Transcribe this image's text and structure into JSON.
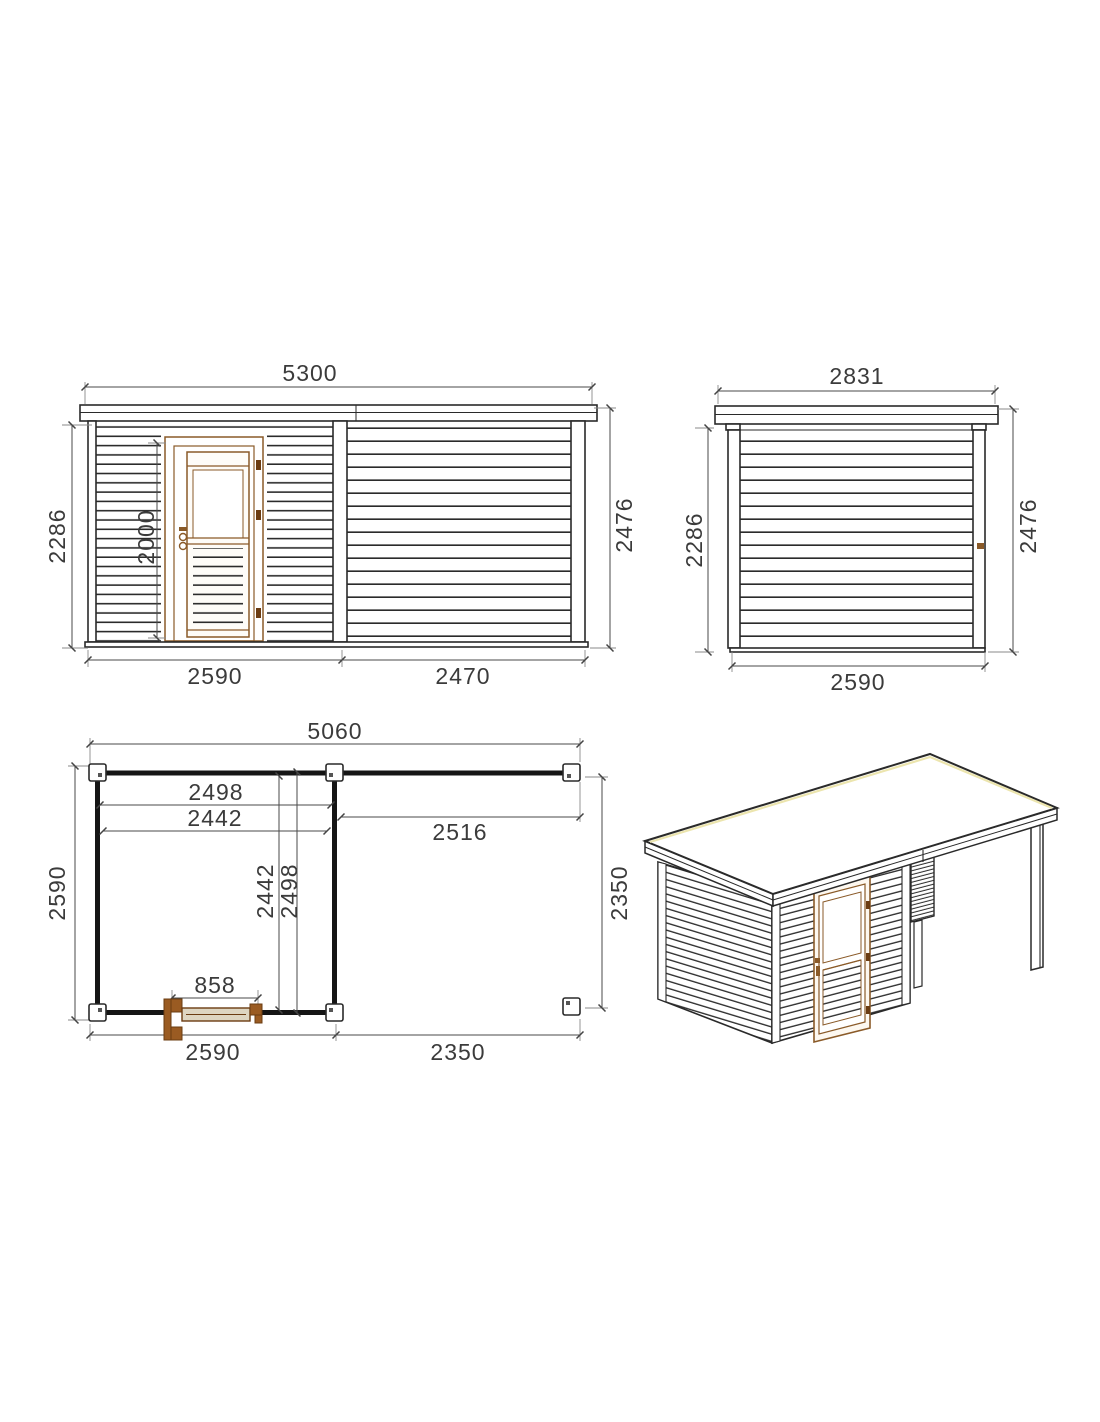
{
  "colors": {
    "line": "#2a2a2a",
    "dimension_line": "#4a4a4a",
    "text": "#3b3b3b",
    "door_frame_brown": "#8a5a28",
    "door_hardware_dark_brown": "#6b3c12",
    "door_leaf_tan": "#ded6c2",
    "roof_edge_highlight": "#ece5ae",
    "background": "#ffffff"
  },
  "front_elevation": {
    "dims": {
      "total_width": "5300",
      "wall_height_left": "2286",
      "door_height": "2000",
      "overall_height_right": "2476",
      "cabin_width": "2590",
      "canopy_width": "2470"
    }
  },
  "side_elevation": {
    "dims": {
      "roof_width": "2831",
      "wall_height_left": "2286",
      "overall_height_right": "2476",
      "base_width": "2590"
    }
  },
  "floor_plan": {
    "dims": {
      "total_width": "5060",
      "room_outer_width": "2498",
      "room_inner_width": "2442",
      "canopy_span": "2516",
      "room_inner_depth_v": "2442",
      "room_outer_depth_v": "2498",
      "left_depth": "2590",
      "right_depth": "2350",
      "door_width": "858",
      "bottom_cabin_width": "2590",
      "bottom_canopy_width": "2350"
    }
  }
}
